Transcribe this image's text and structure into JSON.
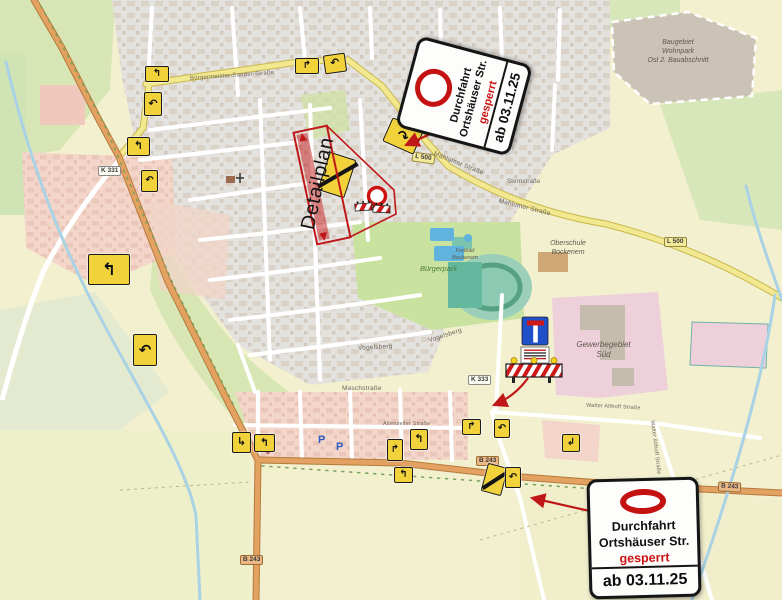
{
  "closure_sign": {
    "line1": "Durchfahrt",
    "line2": "Ortshäuser Str.",
    "gesperrt": "gesperrt",
    "date": "ab 03.11.25"
  },
  "detailplan": {
    "label": "Detailplan"
  },
  "road_labels": {
    "k331": "K 331",
    "l500_town": "L 500",
    "l500_east": "L 500",
    "k333": "K 333",
    "b243_mid": "B 243",
    "b243_south": "B 243",
    "b243_east": "B 243"
  },
  "streets": {
    "buergermeister": "Bürgermeister-Sander-Straße",
    "mahlumer1": "Mahlumer Straße",
    "mahlumer2": "Mahlumer Straße",
    "sternstrasse": "Sternstraße",
    "vogelsberg1": "Vogelsberg",
    "vogelsberg2": "Vogelsberg",
    "maschstrasse": "Maschstraße",
    "altenzeller": "Altenzeller Straße",
    "walter1": "Walter Althoff Straße",
    "walter2": "Walter Althoff Straße"
  },
  "areas": {
    "baugebiet": {
      "l1": "Baugebiet",
      "l2": "Wohnpark",
      "l3": "Ost 2. Bauabschnitt"
    },
    "gewerbegebiet": {
      "l1": "Gewerbegebiet",
      "l2": "Süd"
    },
    "oberschule": {
      "l1": "Oberschule",
      "l2": "Bockenem"
    },
    "freibad": {
      "l1": "Freibad",
      "l2": "Bockenem"
    },
    "buergerpark": "Bürgerpark"
  },
  "parking": {
    "p": "P"
  },
  "detour_arrows": [
    "↰",
    "↶",
    "↰",
    "↶",
    "↰",
    "↶",
    "↱",
    "↶",
    "↷",
    "↳",
    "↰",
    "↱",
    "↰",
    "↱",
    "↶",
    "↰",
    "↶",
    "↲"
  ],
  "colors": {
    "sign_red": "#c41111",
    "annotation_red": "#c01818",
    "detour_yellow": "#f1d23b",
    "road_yellow": "#f2e88f",
    "road_orange": "#e3a262",
    "water_blue": "#a9d2e4",
    "park_green": "#c9e2a0",
    "residential_pink": "#f3d6c9",
    "commercial_pink": "#eed0da",
    "urban_gray": "#e4e2de"
  }
}
